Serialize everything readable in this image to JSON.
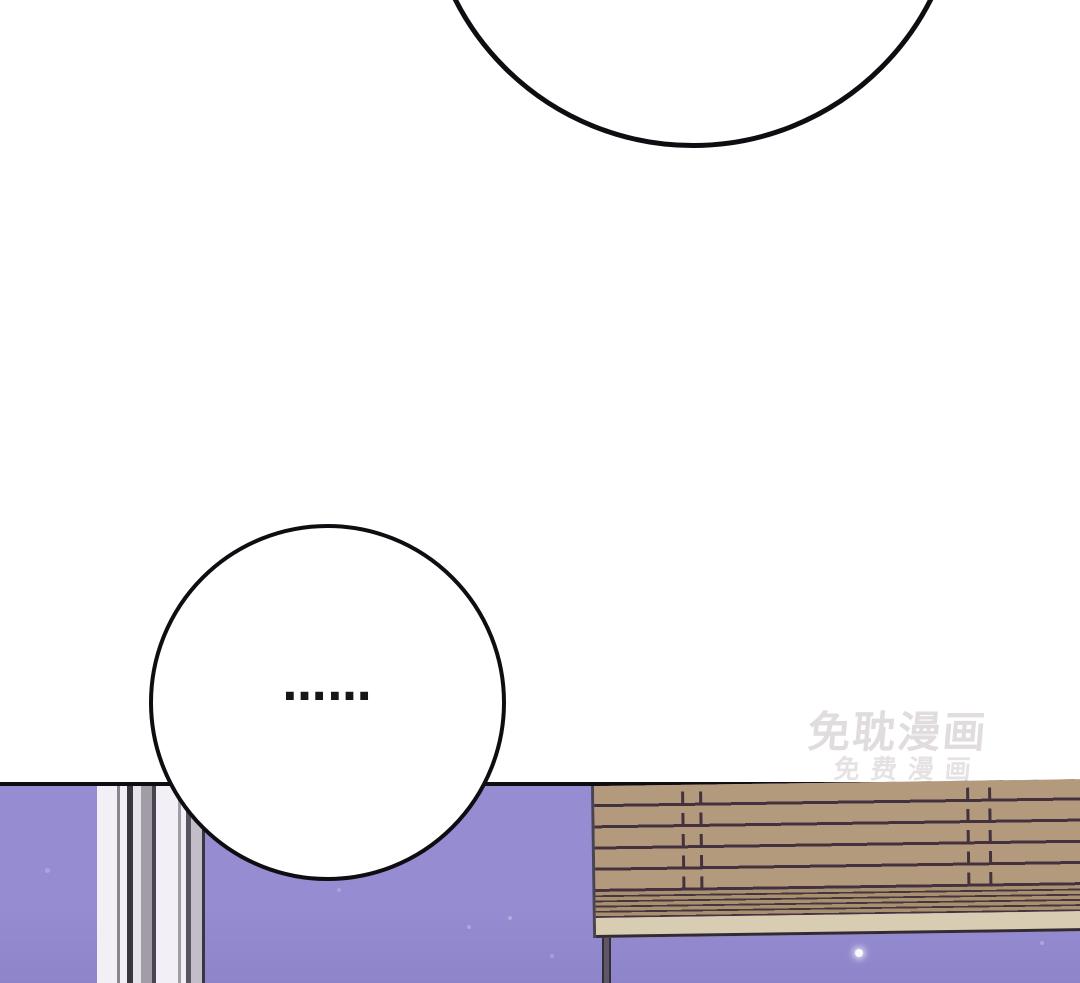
{
  "bubbles": {
    "top": {
      "text": ""
    },
    "middle": {
      "text": "……"
    }
  },
  "watermark": {
    "line1": "免耽漫画",
    "line2": "免费漫画"
  },
  "palette": {
    "paper": "#ffffff",
    "ink": "#0f0d12",
    "purple": "#958cd1",
    "wood": "#b49a7d",
    "wood_line": "#43323e",
    "seat_edge": "#a9906f",
    "seat_edge_line": "#473441",
    "board": "#d8ccb2",
    "board_line": "#332b33",
    "leg": "#5f5765",
    "leg_edge": "#332d3a",
    "frame_white": "#f2f0f6",
    "frame_light": "#e6e4ea",
    "frame_gray": "#a29ca6",
    "frame_gray2": "#5a5560",
    "frame_mid": "#c2bdc8",
    "frame_dark": "#3b3540",
    "frame_dark2": "#4a4450",
    "frame_edge": "#8a8590",
    "watermark_color": "#dcd7d9"
  }
}
